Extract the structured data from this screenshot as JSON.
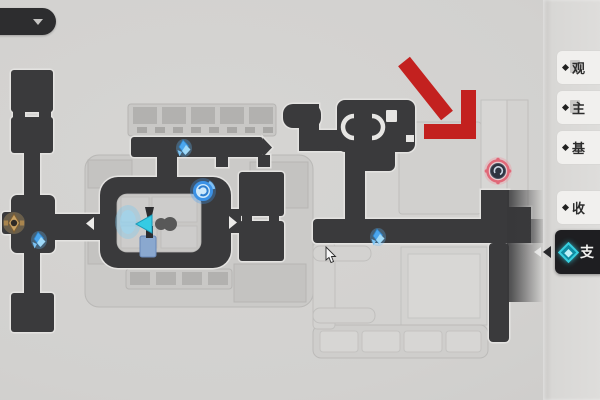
{
  "screen": {
    "type": "game-map-screen"
  },
  "header": {
    "left_pill": {
      "icon": "dropdown-triangle"
    },
    "right_pill": {
      "icon": "none"
    }
  },
  "legend_panel": {
    "items": [
      {
        "label": "观",
        "icon": "diamond-bullet",
        "selected": false
      },
      {
        "label": "主",
        "icon": "diamond-bullet",
        "selected": false
      },
      {
        "label": "基",
        "icon": "diamond-bullet",
        "selected": false
      },
      {
        "label": "收",
        "icon": "diamond-bullet",
        "selected": false
      },
      {
        "label": "支",
        "icon": "teleport-gem",
        "selected": true
      }
    ]
  },
  "map": {
    "markers": [
      {
        "name": "teleport-spark",
        "x": 184,
        "y": 148
      },
      {
        "name": "space-anchor-swirl",
        "x": 203,
        "y": 191
      },
      {
        "name": "teleport-spark",
        "x": 39,
        "y": 240
      },
      {
        "name": "teleport-spark",
        "x": 378,
        "y": 237
      },
      {
        "name": "gold-emblem",
        "x": 14,
        "y": 223
      },
      {
        "name": "red-ring-marker",
        "x": 498,
        "y": 171
      },
      {
        "name": "player-totem",
        "x": 146,
        "y": 224
      }
    ],
    "annotation_arrow": {
      "name": "red-arrow",
      "tip_x": 471,
      "tip_y": 139
    },
    "cursor": {
      "x": 326,
      "y": 248
    }
  },
  "colors": {
    "background": "#d2d1cf",
    "corridor_dark": "#3a3a3c",
    "outline_light": "#e4e3e1",
    "room_light": "#cac9c7",
    "annotation_red": "#c3211f",
    "marker_ring_pink": "#e06878",
    "icon_blue": "#4aa6ee",
    "accent_cyan": "#39cede",
    "panel_row": "#f1f0ee",
    "panel_selected": "#1e1e21"
  }
}
